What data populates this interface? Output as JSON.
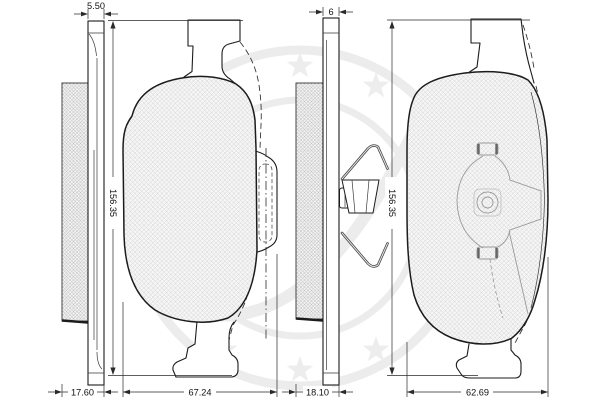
{
  "drawing_type": "brake-pad-technical-drawing",
  "colors": {
    "background": "#ffffff",
    "line": "#1c1c1c",
    "dimension_text": "#111111",
    "watermark": "#ededed",
    "friction_hatch": "#c0c0c0",
    "spring_wire": "#4d4d4d"
  },
  "pads": {
    "left": {
      "plate_thickness": "5.50",
      "assembly_thickness": "17.60",
      "height": "156.35",
      "width": "67.24"
    },
    "right": {
      "plate_thickness": "6",
      "assembly_thickness": "18.10",
      "height": "156.35",
      "width": "62.69"
    }
  }
}
